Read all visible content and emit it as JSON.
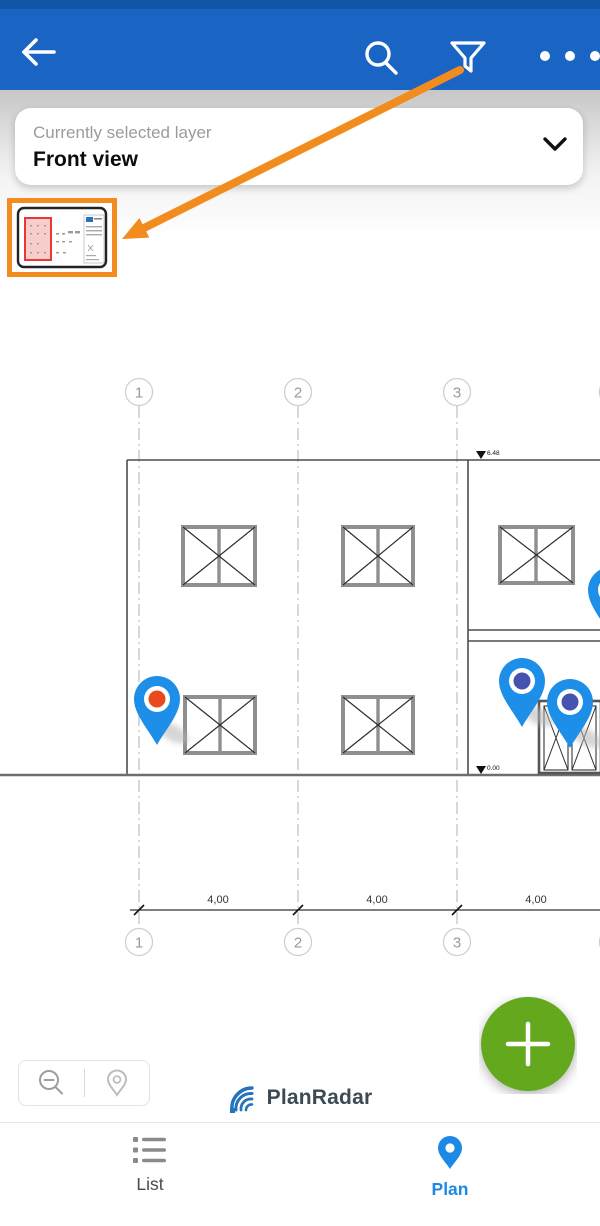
{
  "colors": {
    "header_bg": "#1A65C4",
    "accent_orange": "#F28C1E",
    "pin_body_blue": "#1E8FE8",
    "pin_dot_red": "#E8491D",
    "pin_dot_indigo": "#4553B0",
    "fab_green": "#64A81E",
    "nav_active_blue": "#1E88E5",
    "logo_blue": "#2473BB",
    "highlight_red": "#E53935"
  },
  "layer_selector": {
    "label": "Currently selected layer",
    "value": "Front view"
  },
  "plan": {
    "grid_labels": [
      "1",
      "2",
      "3"
    ],
    "dimension_labels": [
      "4,00",
      "4,00",
      "4,00"
    ],
    "level_top": "6.48",
    "level_ground": "0.00",
    "pins": [
      {
        "name": "issue-pin-red",
        "dot_color": "#E8491D"
      },
      {
        "name": "issue-pin-indigo-1",
        "dot_color": "#4553B0"
      },
      {
        "name": "issue-pin-indigo-2",
        "dot_color": "#4553B0"
      },
      {
        "name": "issue-pin-indigo-3-partial",
        "dot_color": "#4553B0"
      }
    ]
  },
  "footer": {
    "logo_text": "PlanRadar",
    "fab_label": "+"
  },
  "bottom_nav": {
    "items": [
      {
        "label": "List",
        "active": false
      },
      {
        "label": "Plan",
        "active": true
      }
    ]
  }
}
